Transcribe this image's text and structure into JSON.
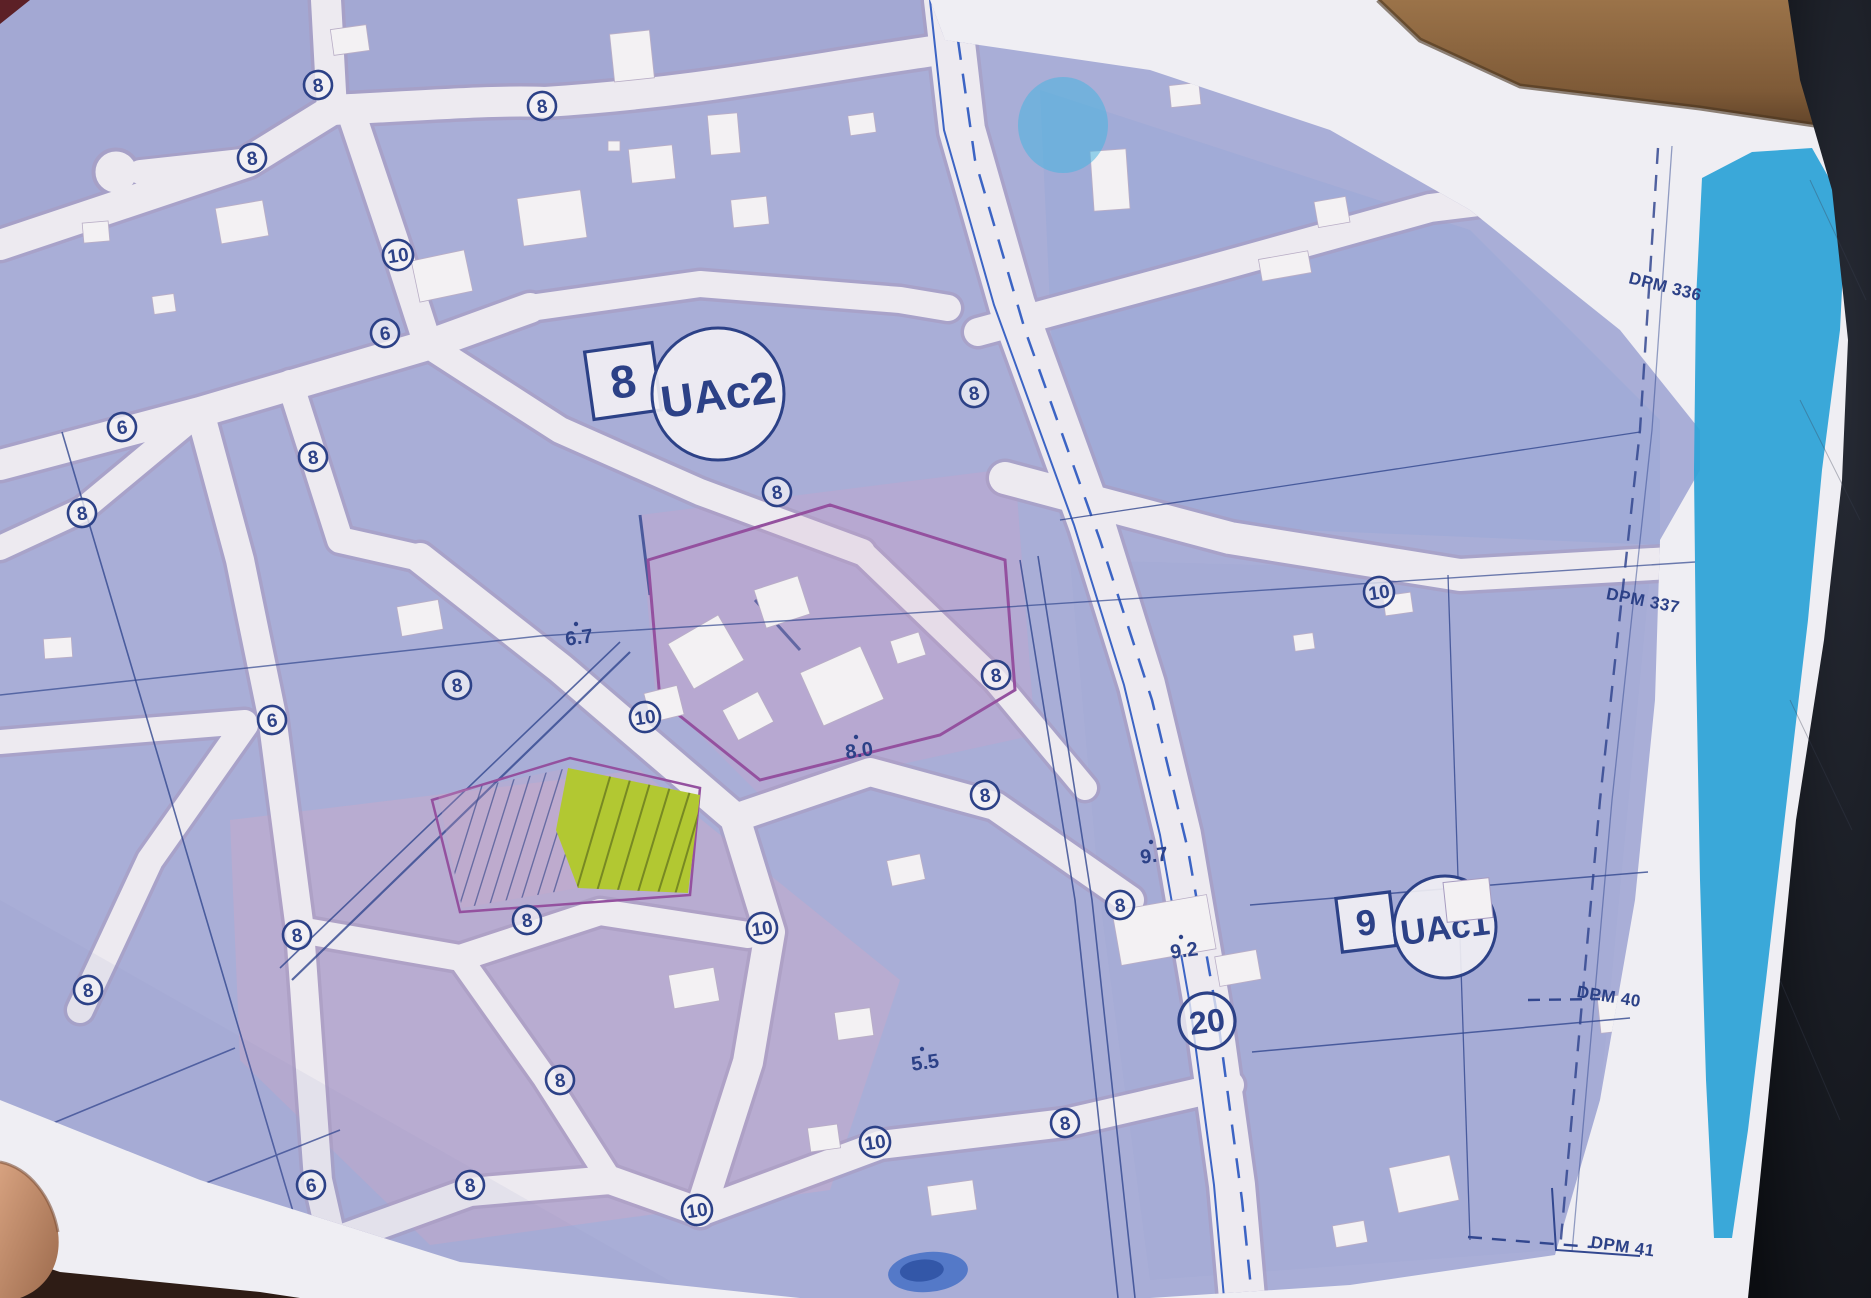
{
  "photo": {
    "background_colors": {
      "table_dark": "#14161d",
      "wood_strip": "#8a6443",
      "finger_skin": "#c78f6d"
    }
  },
  "map": {
    "colors": {
      "paper": "#efeef3",
      "block_lavender": "#a9aed7",
      "road_fill": "#edeaf0",
      "road_edge": "#a89bc0",
      "line_navy": "#2c4187",
      "water_blue": "#2fa3d7",
      "highlight_green": "#b2c832",
      "parcel_purple": "#94519f",
      "boulevard_blue": "#3c64c4",
      "ink_smudge": "#3f6cc4"
    },
    "zone_labels": [
      {
        "number": "8",
        "name": "UAc2",
        "sq_cx": 623,
        "sq_cy": 381,
        "sq_half": 34,
        "c_cx": 718,
        "c_cy": 394,
        "c_r": 66,
        "num_size": 46,
        "name_size": 45,
        "rot": -8
      },
      {
        "number": "9",
        "name": "UAc1",
        "sq_cx": 1366,
        "sq_cy": 922,
        "sq_half": 27,
        "c_cx": 1445,
        "c_cy": 927,
        "c_r": 51,
        "num_size": 36,
        "name_size": 35,
        "rot": -7
      }
    ],
    "road_width_markers": [
      {
        "value": "8",
        "x": 318,
        "y": 85,
        "r": 14
      },
      {
        "value": "8",
        "x": 542,
        "y": 106,
        "r": 14
      },
      {
        "value": "8",
        "x": 252,
        "y": 158,
        "r": 14
      },
      {
        "value": "10",
        "x": 398,
        "y": 255,
        "r": 15
      },
      {
        "value": "6",
        "x": 385,
        "y": 333,
        "r": 14
      },
      {
        "value": "6",
        "x": 122,
        "y": 427,
        "r": 14
      },
      {
        "value": "8",
        "x": 313,
        "y": 457,
        "r": 14
      },
      {
        "value": "8",
        "x": 82,
        "y": 513,
        "r": 14
      },
      {
        "value": "8",
        "x": 777,
        "y": 492,
        "r": 14
      },
      {
        "value": "8",
        "x": 974,
        "y": 393,
        "r": 14
      },
      {
        "value": "10",
        "x": 1379,
        "y": 592,
        "r": 15
      },
      {
        "value": "8",
        "x": 996,
        "y": 675,
        "r": 14
      },
      {
        "value": "8",
        "x": 985,
        "y": 795,
        "r": 14
      },
      {
        "value": "6",
        "x": 272,
        "y": 720,
        "r": 14
      },
      {
        "value": "8",
        "x": 457,
        "y": 685,
        "r": 14
      },
      {
        "value": "10",
        "x": 645,
        "y": 717,
        "r": 15
      },
      {
        "value": "8",
        "x": 297,
        "y": 935,
        "r": 14
      },
      {
        "value": "8",
        "x": 527,
        "y": 920,
        "r": 14
      },
      {
        "value": "10",
        "x": 762,
        "y": 928,
        "r": 15
      },
      {
        "value": "8",
        "x": 1120,
        "y": 905,
        "r": 14
      },
      {
        "value": "20",
        "x": 1207,
        "y": 1021,
        "r": 28
      },
      {
        "value": "8",
        "x": 88,
        "y": 990,
        "r": 14
      },
      {
        "value": "6",
        "x": 311,
        "y": 1185,
        "r": 14
      },
      {
        "value": "8",
        "x": 470,
        "y": 1185,
        "r": 14
      },
      {
        "value": "8",
        "x": 560,
        "y": 1080,
        "r": 14
      },
      {
        "value": "10",
        "x": 697,
        "y": 1210,
        "r": 15
      },
      {
        "value": "10",
        "x": 875,
        "y": 1142,
        "r": 15
      },
      {
        "value": "8",
        "x": 1065,
        "y": 1123,
        "r": 14
      }
    ],
    "spot_heights": [
      {
        "value": "6.7",
        "x": 580,
        "y": 644
      },
      {
        "value": "8.0",
        "x": 860,
        "y": 757
      },
      {
        "value": "9.7",
        "x": 1155,
        "y": 862
      },
      {
        "value": "9.2",
        "x": 1185,
        "y": 957
      },
      {
        "value": "5.5",
        "x": 926,
        "y": 1069
      }
    ],
    "boundary_labels": [
      {
        "text": "DPM 336",
        "x": 1664,
        "y": 292,
        "rot": 14
      },
      {
        "text": "DPM 337",
        "x": 1642,
        "y": 606,
        "rot": 11
      },
      {
        "text": "DPM 40",
        "x": 1608,
        "y": 1002,
        "rot": 9
      },
      {
        "text": "DPM 41",
        "x": 1622,
        "y": 1252,
        "rot": 8
      }
    ]
  }
}
